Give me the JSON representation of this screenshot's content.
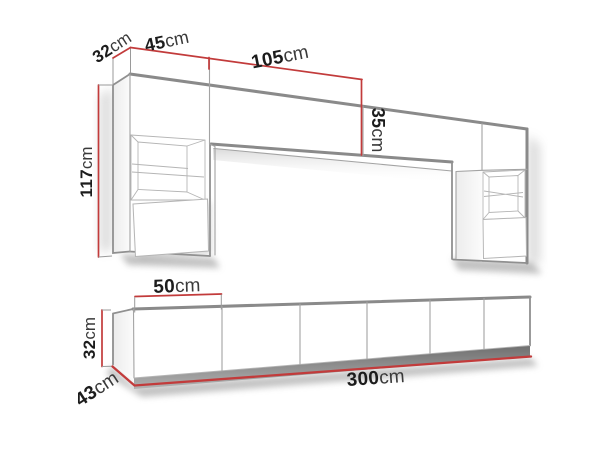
{
  "diagram_title": "furniture-set-dimensions",
  "colors": {
    "background": "#ffffff",
    "dimension_red": "#c23b3b",
    "furniture_outline_gray": "#8a8a8a",
    "detail_line_gray": "#a3a3a3",
    "label_text": "#1c1c1c",
    "plinth_dark_gray": "#6f6f6f"
  },
  "wall_unit": {
    "depth_label": {
      "value": "32",
      "unit": "cm"
    },
    "cabinet_width_label": {
      "value": "45",
      "unit": "cm"
    },
    "bridge_width_label": {
      "value": "105",
      "unit": "cm"
    },
    "bridge_height_label": {
      "value": "35",
      "unit": "cm"
    },
    "column_height_label": {
      "value": "117",
      "unit": "cm"
    }
  },
  "tv_stand": {
    "door_width_label": {
      "value": "50",
      "unit": "cm"
    },
    "height_label": {
      "value": "32",
      "unit": "cm"
    },
    "depth_label": {
      "value": "43",
      "unit": "cm"
    },
    "total_width_label": {
      "value": "300",
      "unit": "cm"
    }
  }
}
